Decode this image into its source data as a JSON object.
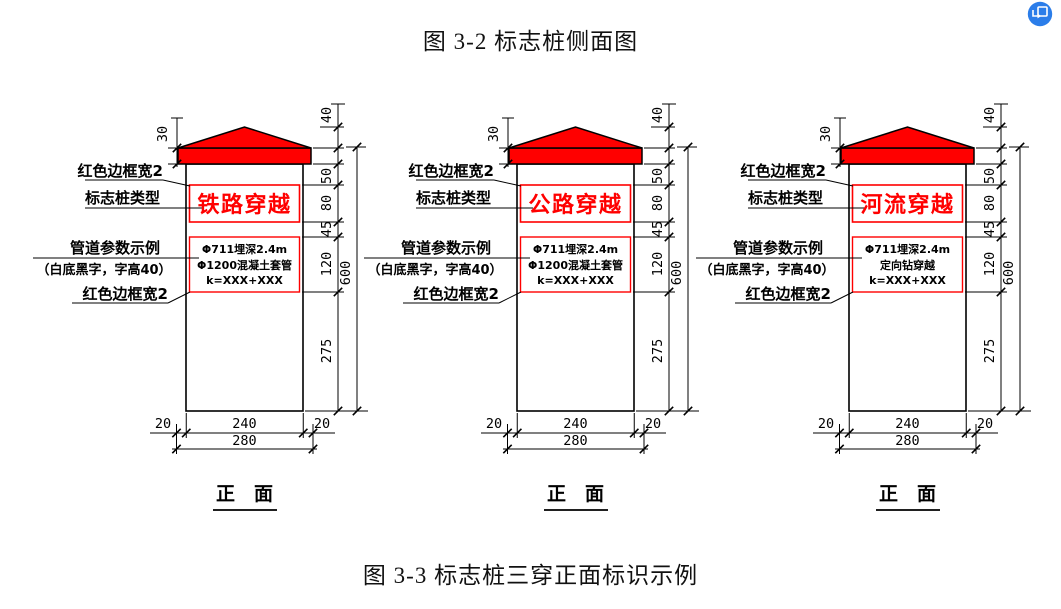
{
  "titles": {
    "top": "图 3-2 标志桩侧面图",
    "bottom": "图 3-3 标志桩三穿正面标识示例"
  },
  "view_label": "正　面",
  "annotations": {
    "border_top": "红色边框宽2",
    "post_type": "标志桩类型",
    "param_title": "管道参数示例",
    "param_note": "（白底黑字，字高40）",
    "border_bottom": "红色边框宽2"
  },
  "dimensions": {
    "cap": "40",
    "band": "30",
    "seg_top_gap": "50",
    "type_box": "80",
    "mid_gap": "45",
    "param_box": "120",
    "lower": "275",
    "total_height": "600",
    "margin_left": "20",
    "inner_width": "240",
    "margin_right": "20",
    "outer_width": "280"
  },
  "posts": [
    {
      "type_label": "铁路穿越",
      "param_lines": [
        "Φ711埋深2.4m",
        "Φ1200混凝土套管",
        "k=XXX+XXX"
      ]
    },
    {
      "type_label": "公路穿越",
      "param_lines": [
        "Φ711埋深2.4m",
        "Φ1200混凝土套管",
        "k=XXX+XXX"
      ]
    },
    {
      "type_label": "河流穿越",
      "param_lines": [
        "Φ711埋深2.4m",
        "定向钻穿越",
        "k=XXX+XXX"
      ]
    }
  ],
  "colors": {
    "red": "#ff0000",
    "line": "#000000",
    "icon_blue": "#2b7de9"
  },
  "corner_icon": "save-image"
}
